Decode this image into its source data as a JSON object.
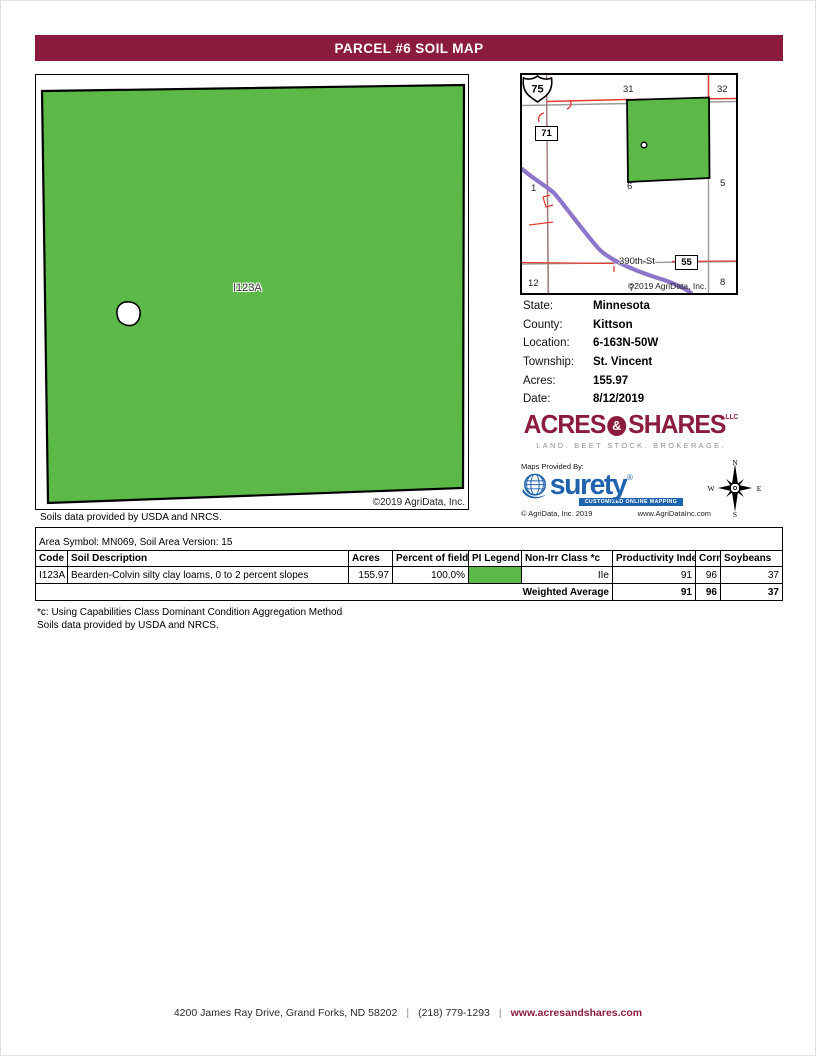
{
  "header": {
    "title": "PARCEL #6 SOIL MAP"
  },
  "colors": {
    "maroon": "#8B1C3D",
    "soil_green": "#5CB948",
    "highway_purple": "#8D76C9",
    "road_red": "#E23B2E",
    "road_gray": "#9B9B9B",
    "surety_blue": "#1F63AD"
  },
  "main_map": {
    "soil_label": "I123A",
    "copyright": "©2019 AgriData, Inc.",
    "soils_note": "Soils data provided by USDA and NRCS."
  },
  "inset_map": {
    "sections": [
      "36",
      "31",
      "32",
      "1",
      "6",
      "5",
      "12",
      "7",
      "8"
    ],
    "route_71": "71",
    "route_75": "75",
    "route_55": "55",
    "street_label": "390th-St",
    "copyright": "©2019 AgriData, Inc."
  },
  "info": {
    "rows": [
      {
        "label": "State:",
        "value": "Minnesota"
      },
      {
        "label": "County:",
        "value": "Kittson"
      },
      {
        "label": "Location:",
        "value": "6-163N-50W"
      },
      {
        "label": "Township:",
        "value": "St. Vincent"
      },
      {
        "label": "Acres:",
        "value": "155.97"
      },
      {
        "label": "Date:",
        "value": "8/12/2019"
      }
    ]
  },
  "brand": {
    "name_left": "ACRES",
    "amp": "&",
    "name_right": "SHARES",
    "suffix": "LLC",
    "tagline": "LAND. BEET STOCK. BROKERAGE."
  },
  "surety": {
    "provided_by": "Maps Provided By:",
    "wordmark": "surety",
    "reg": "®",
    "subtitle": "CUSTOMIZED ONLINE MAPPING",
    "copyright": "© AgriData, Inc. 2019",
    "website": "www.AgriDataInc.com"
  },
  "compass": {
    "n": "N",
    "w": "W",
    "e": "E",
    "s": "S"
  },
  "soil_table": {
    "area_line": "Area Symbol: MN069, Soil Area Version: 15",
    "headers": [
      "Code",
      "Soil Description",
      "Acres",
      "Percent of field",
      "PI Legend",
      "Non-Irr Class *c",
      "Productivity Index",
      "Corn",
      "Soybeans"
    ],
    "rows": [
      {
        "code": "I123A",
        "description": "Bearden-Colvin silty clay loams, 0 to 2 percent slopes",
        "acres": "155.97",
        "percent": "100.0%",
        "non_irr": "IIe",
        "productivity_index": "91",
        "corn": "96",
        "soybeans": "37",
        "legend_color": "#5CB948"
      }
    ],
    "weighted": {
      "label": "Weighted Average",
      "productivity_index": "91",
      "corn": "96",
      "soybeans": "37"
    }
  },
  "footnotes": {
    "line1": "*c: Using Capabilities Class Dominant Condition Aggregation Method",
    "line2": "Soils data provided by USDA and NRCS."
  },
  "footer": {
    "address": "4200 James Ray Drive, Grand Forks, ND 58202",
    "pipe": "|",
    "phone": "(218) 779-1293",
    "website": "www.acresandshares.com"
  }
}
